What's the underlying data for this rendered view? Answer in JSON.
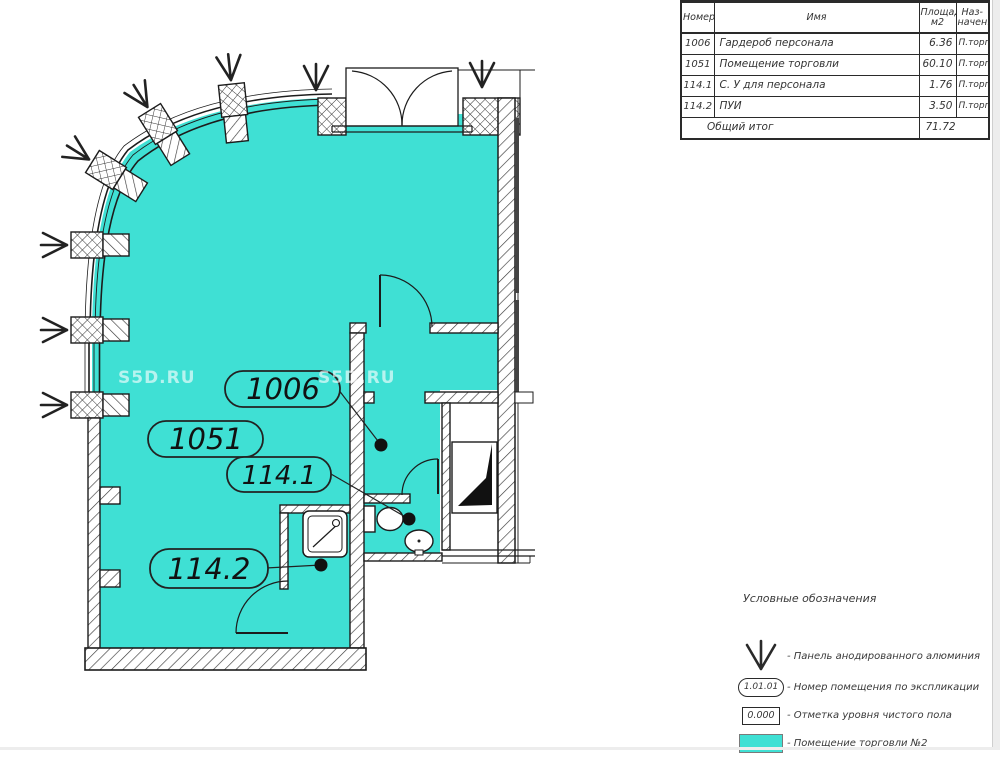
{
  "colors": {
    "room_fill": "#3FE0D4",
    "wall_stroke": "#1c1c1c",
    "text": "#333333"
  },
  "watermark": "S5D.RU",
  "explication_table": {
    "col_number": "Номер",
    "col_name": "Имя",
    "col_area_l1": "Площадь,",
    "col_area_l2": "м2",
    "col_purpose_l1": "Наз-",
    "col_purpose_l2": "начен.",
    "rows": [
      {
        "number": "1006",
        "name": "Гардероб персонала",
        "area": "6.36",
        "purpose": "П.торга"
      },
      {
        "number": "1051",
        "name": "Помещение торговли",
        "area": "60.10",
        "purpose": "П.торга"
      },
      {
        "number": "114.1",
        "name": "С. У для персонала",
        "area": "1.76",
        "purpose": "П.торга"
      },
      {
        "number": "114.2",
        "name": "ПУИ",
        "area": "3.50",
        "purpose": "П.торга"
      }
    ],
    "total_label": "Общий итог",
    "total_area": "71.72"
  },
  "plan_labels": {
    "room_1006": "1006",
    "room_1051": "1051",
    "room_1141": "114.1",
    "room_1142": "114.2"
  },
  "legend": {
    "title": "Условные обозначения",
    "items": [
      {
        "label": "- Панель анодированного алюминия"
      },
      {
        "symbol_text": "1.01.01",
        "label": "- Номер помещения по экспликации"
      },
      {
        "symbol_text": "0.000",
        "label": "- Отметка уровня чистого пола"
      },
      {
        "label": "- Помещение торговли №2"
      }
    ]
  }
}
